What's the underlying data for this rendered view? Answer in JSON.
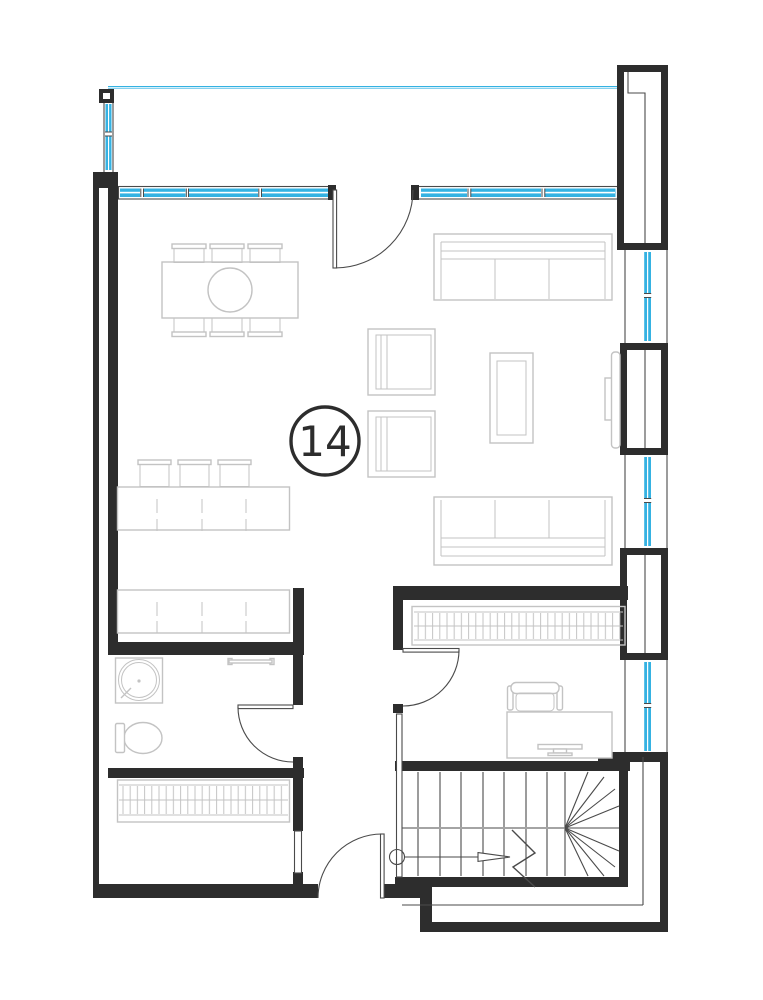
{
  "unit": {
    "number": "14"
  },
  "colors": {
    "wall": "#2d2d2d",
    "line": "#4a4a4a",
    "furniture": "#c3c3c3",
    "glazing": "#35b2e2",
    "background": "#ffffff"
  }
}
